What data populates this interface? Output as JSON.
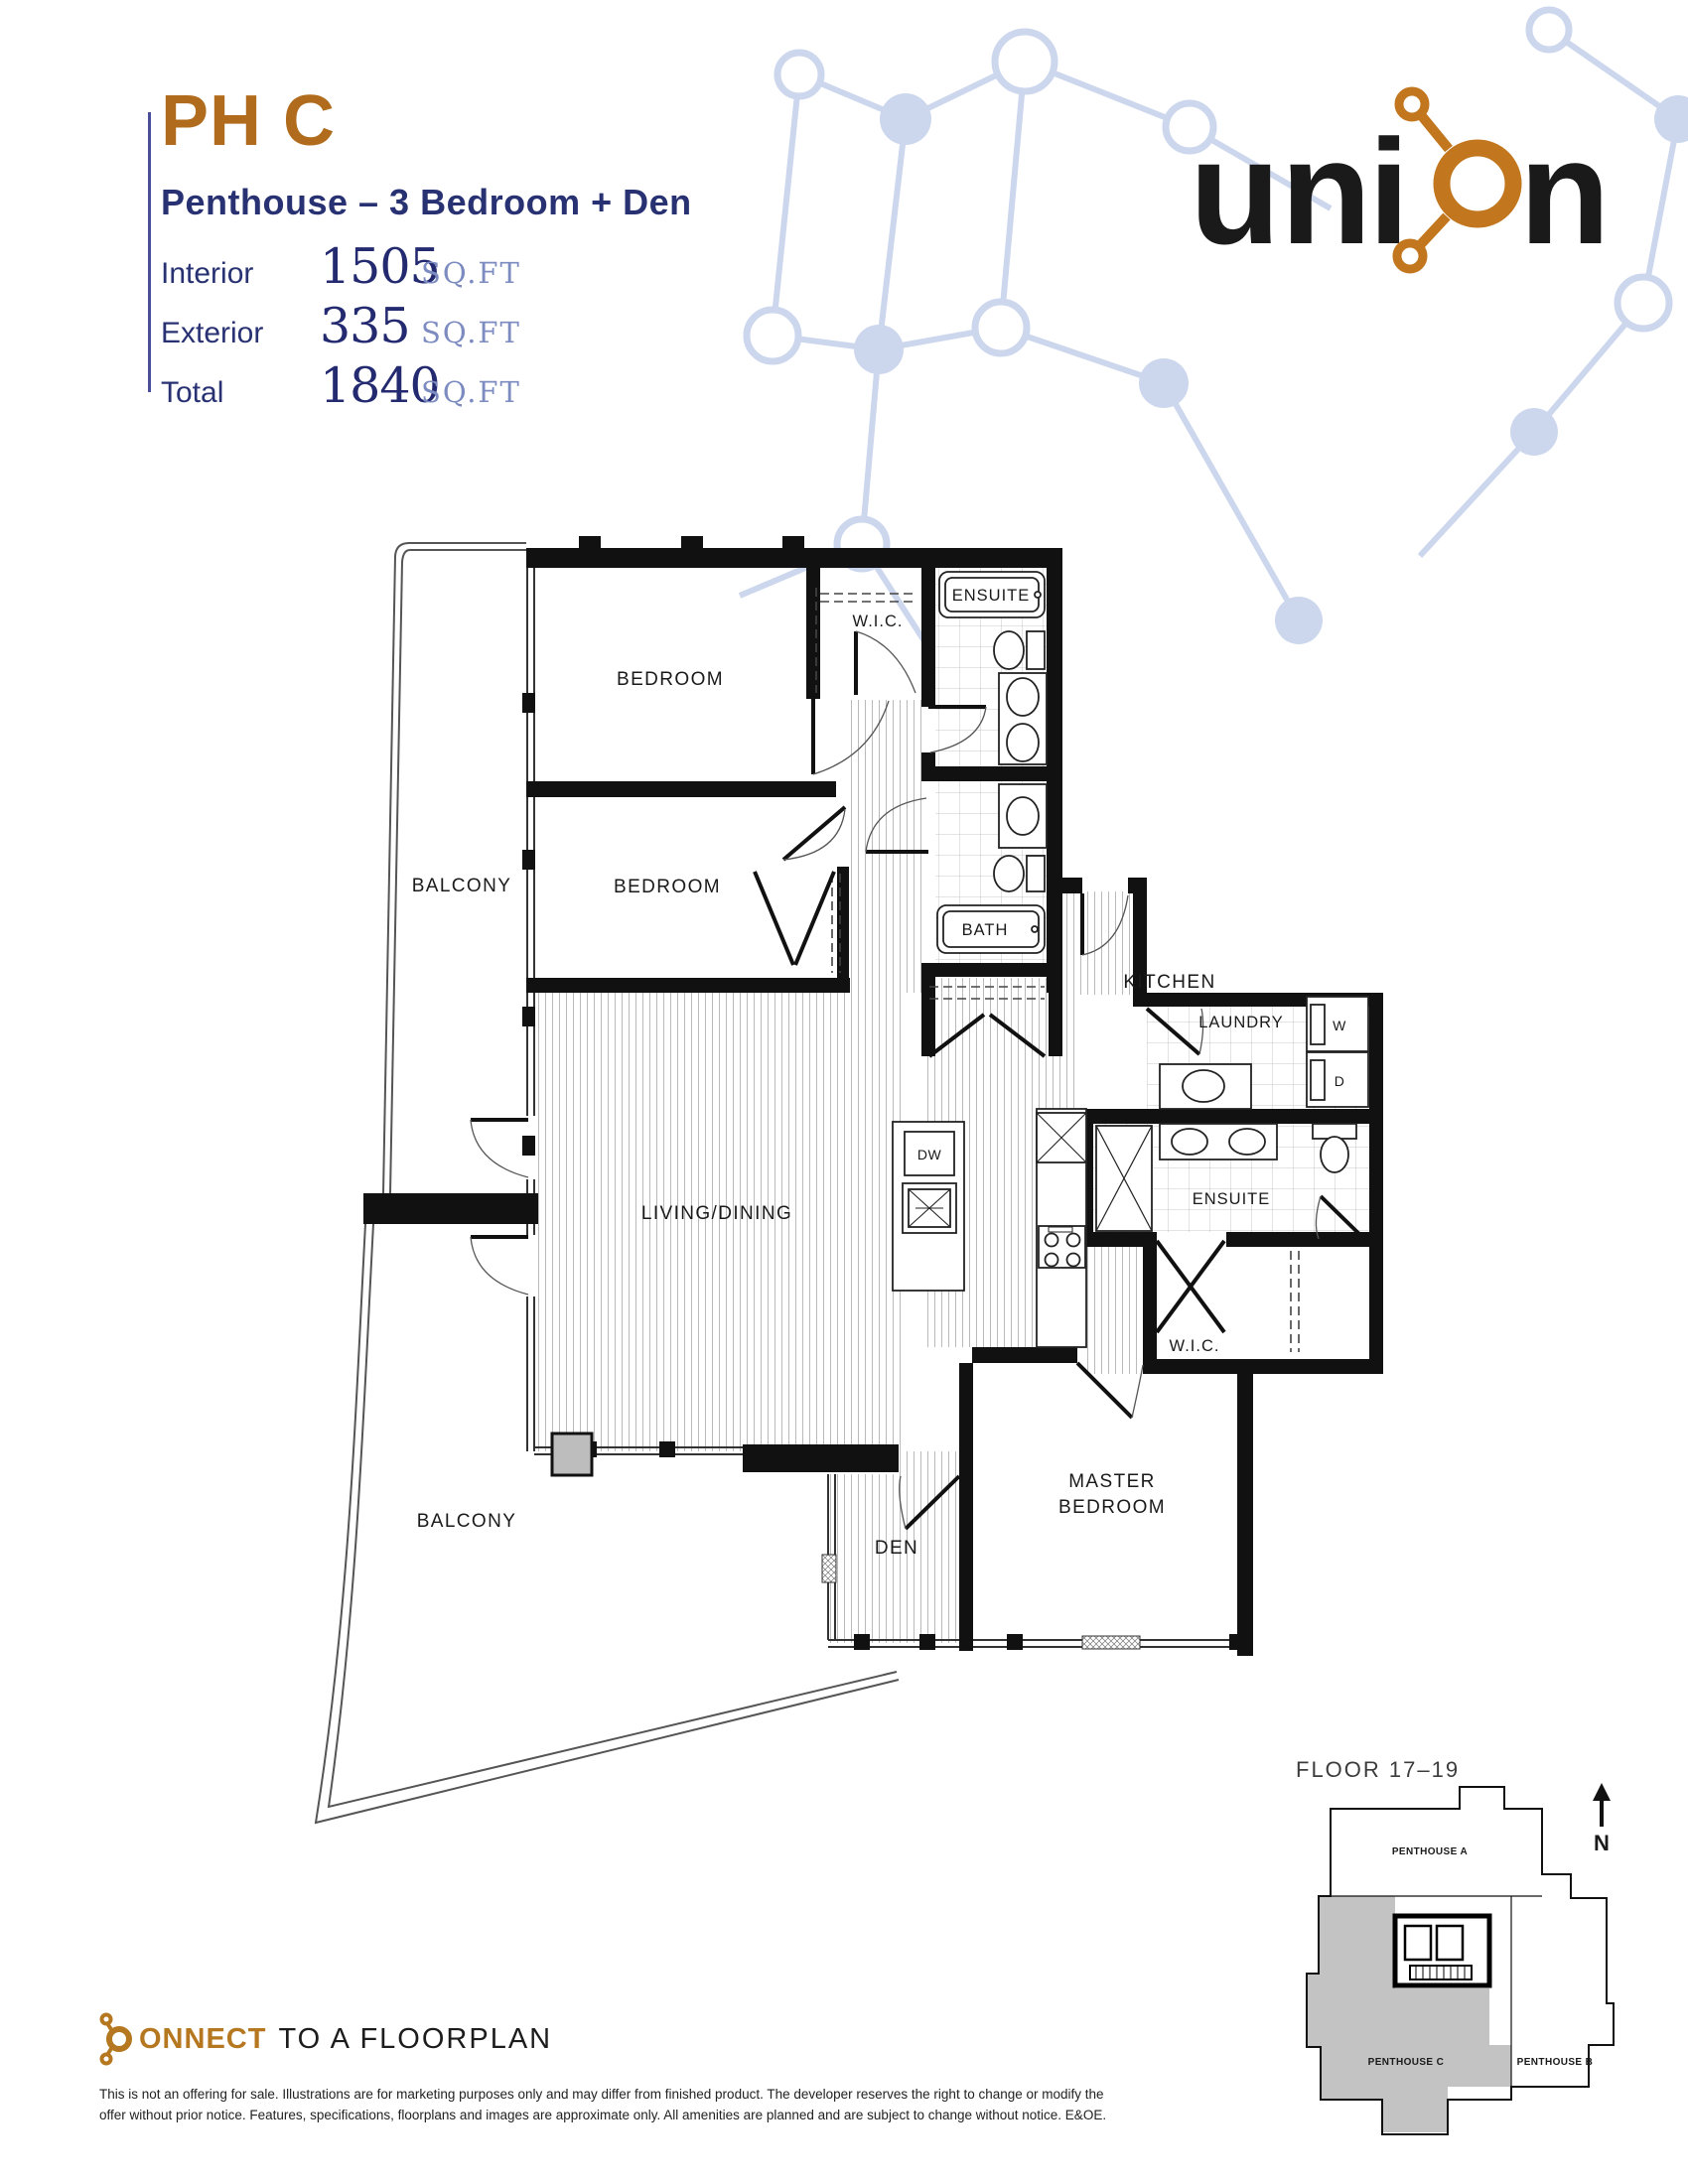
{
  "header": {
    "plan_code": "PH C",
    "plan_description": "Penthouse – 3 Bedroom + Den",
    "area_rows": [
      {
        "label": "Interior",
        "value": "1505",
        "unit": "SQ.FT"
      },
      {
        "label": "Exterior",
        "value": "335",
        "unit": "SQ.FT"
      },
      {
        "label": "Total",
        "value": "1840",
        "unit": "SQ.FT"
      }
    ]
  },
  "logo": {
    "part1": "un",
    "part2": "i",
    "part3": "n"
  },
  "colors": {
    "brand_orange": "#b06c1c",
    "logo_orange": "#c2761d",
    "brand_navy": "#1b1e6e",
    "text_navy": "#283273",
    "sqft_blue": "#7d8cc0",
    "network_blue": "#ccd7ee",
    "keyplan_gray": "#c3c3c3"
  },
  "floorplan": {
    "labels": [
      {
        "id": "bedroom-1",
        "text": "BEDROOM"
      },
      {
        "id": "bedroom-2",
        "text": "BEDROOM"
      },
      {
        "id": "wic-1",
        "text": "W.I.C."
      },
      {
        "id": "ensuite-1",
        "text": "ENSUITE"
      },
      {
        "id": "bath",
        "text": "BATH"
      },
      {
        "id": "balcony-1",
        "text": "BALCONY"
      },
      {
        "id": "balcony-2",
        "text": "BALCONY"
      },
      {
        "id": "living-dining",
        "text": "LIVING/DINING"
      },
      {
        "id": "kitchen",
        "text": "KITCHEN"
      },
      {
        "id": "laundry",
        "text": "LAUNDRY"
      },
      {
        "id": "washer",
        "text": "W"
      },
      {
        "id": "dryer",
        "text": "D"
      },
      {
        "id": "dishwasher",
        "text": "DW"
      },
      {
        "id": "ensuite-2",
        "text": "ENSUITE"
      },
      {
        "id": "wic-2",
        "text": "W.I.C."
      },
      {
        "id": "master-line1",
        "text": "MASTER"
      },
      {
        "id": "master-line2",
        "text": "BEDROOM"
      },
      {
        "id": "den",
        "text": "DEN"
      }
    ]
  },
  "keyplan": {
    "title": "FLOOR 17–19",
    "north_label": "N",
    "units": [
      {
        "name": "PENTHOUSE A",
        "highlighted": false
      },
      {
        "name": "PENTHOUSE C",
        "highlighted": true
      },
      {
        "name": "PENTHOUSE B",
        "highlighted": false
      }
    ]
  },
  "footer": {
    "logo_text": "ONNECT",
    "tagline": "TO A FLOORPLAN",
    "disclaimer_line1": "This is not an offering for sale. Illustrations are for marketing purposes only and may differ from finished product. The developer reserves the right to change or modify the",
    "disclaimer_line2": "offer without prior notice. Features, specifications, floorplans and images are approximate only. All amenities are planned and are subject to change without notice. E&OE."
  }
}
